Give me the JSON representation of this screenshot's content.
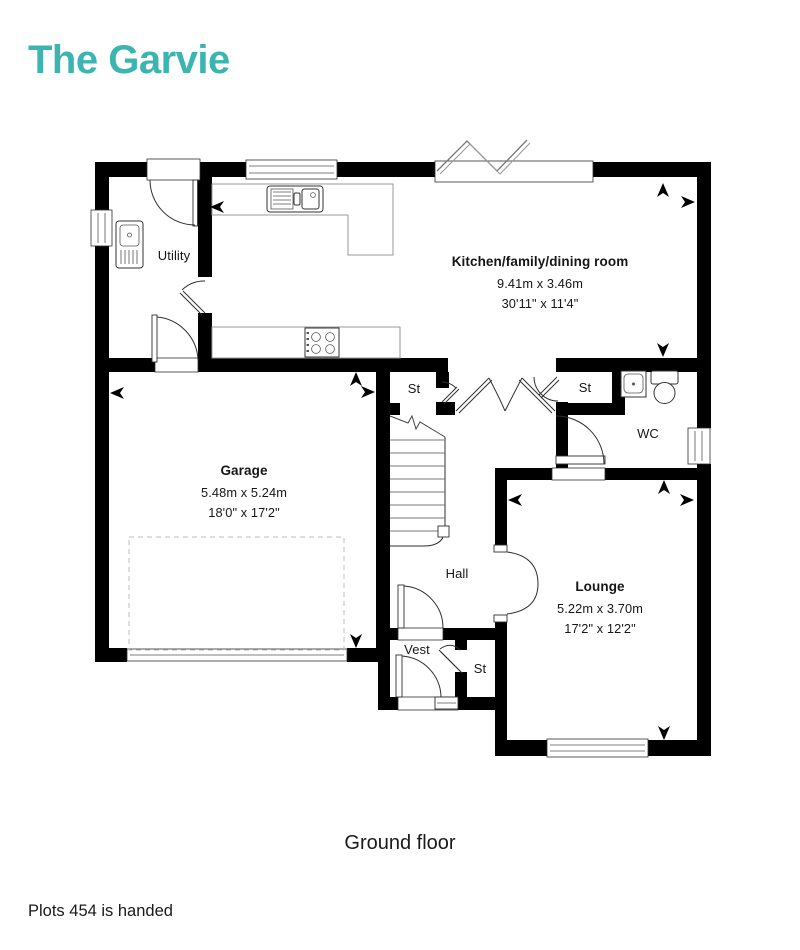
{
  "page": {
    "title": "The Garvie",
    "floor_caption": "Ground floor",
    "footnote": "Plots 454 is handed"
  },
  "colors": {
    "accent": "#3cb4b0",
    "text": "#1a1a1a",
    "wall": "#000000"
  },
  "rooms": {
    "kitchen": {
      "name": "Kitchen/family/dining room",
      "metric": "9.41m x 3.46m",
      "imperial": "30'11\" x 11'4\""
    },
    "utility": {
      "name": "Utility"
    },
    "garage": {
      "name": "Garage",
      "metric": "5.48m x 5.24m",
      "imperial": "18'0\" x 17'2\""
    },
    "lounge": {
      "name": "Lounge",
      "metric": "5.22m x 3.70m",
      "imperial": "17'2\" x 12'2\""
    },
    "wc": {
      "name": "WC"
    },
    "hall": {
      "name": "Hall"
    },
    "vest": {
      "name": "Vest"
    },
    "store_top_left": {
      "name": "St"
    },
    "store_top_right": {
      "name": "St"
    },
    "store_bottom": {
      "name": "St"
    }
  },
  "fixtures": [
    "utility-sink",
    "kitchen-sink",
    "hob",
    "wc-basin",
    "toilet",
    "staircase",
    "garage-door",
    "bifold-doors"
  ]
}
